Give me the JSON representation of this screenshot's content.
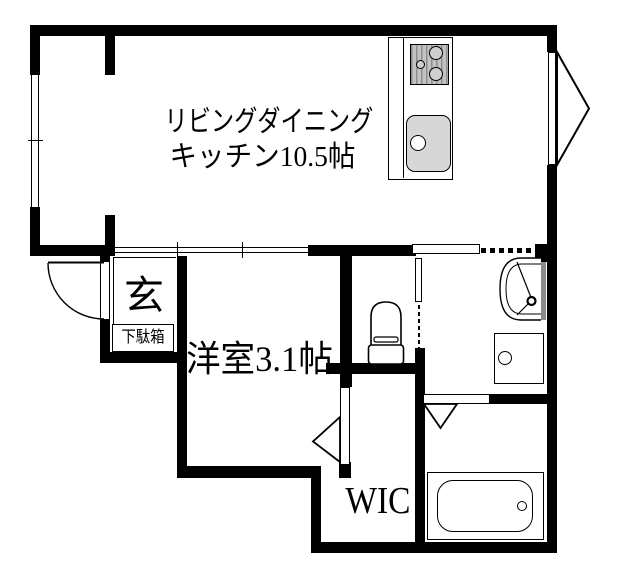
{
  "rooms": {
    "ldk": {
      "line1": "リビングダイニング",
      "line2": "キッチン10.5帖"
    },
    "entrance": {
      "label": "玄",
      "shoe_cabinet": "下駄箱"
    },
    "western_room": {
      "label": "洋室3.1帖"
    },
    "wic": {
      "label": "WIC"
    }
  },
  "fixtures": {
    "kitchen": [
      "gas-stove",
      "kitchen-sink",
      "counter"
    ],
    "sanitary": [
      "toilet",
      "washbasin",
      "washing-machine-pan",
      "bathtub"
    ]
  },
  "colors": {
    "wall": "#000000",
    "background": "#ffffff",
    "sink_gray": "#d7d7d7",
    "stove_gray": "#b5b5b5",
    "cabinet_gray": "#8c8c8c"
  }
}
